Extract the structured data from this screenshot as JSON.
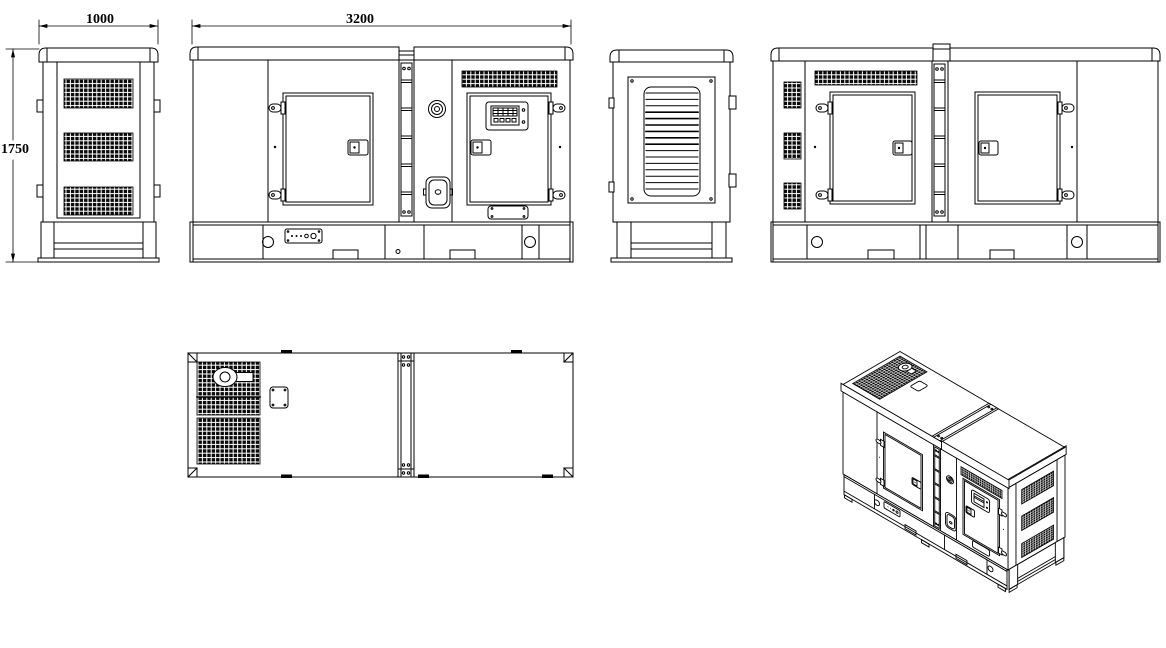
{
  "drawing": {
    "background_color": "#ffffff",
    "line_color": "#000000",
    "dimensions": {
      "width": "1000",
      "length": "3200",
      "height": "1750"
    }
  }
}
